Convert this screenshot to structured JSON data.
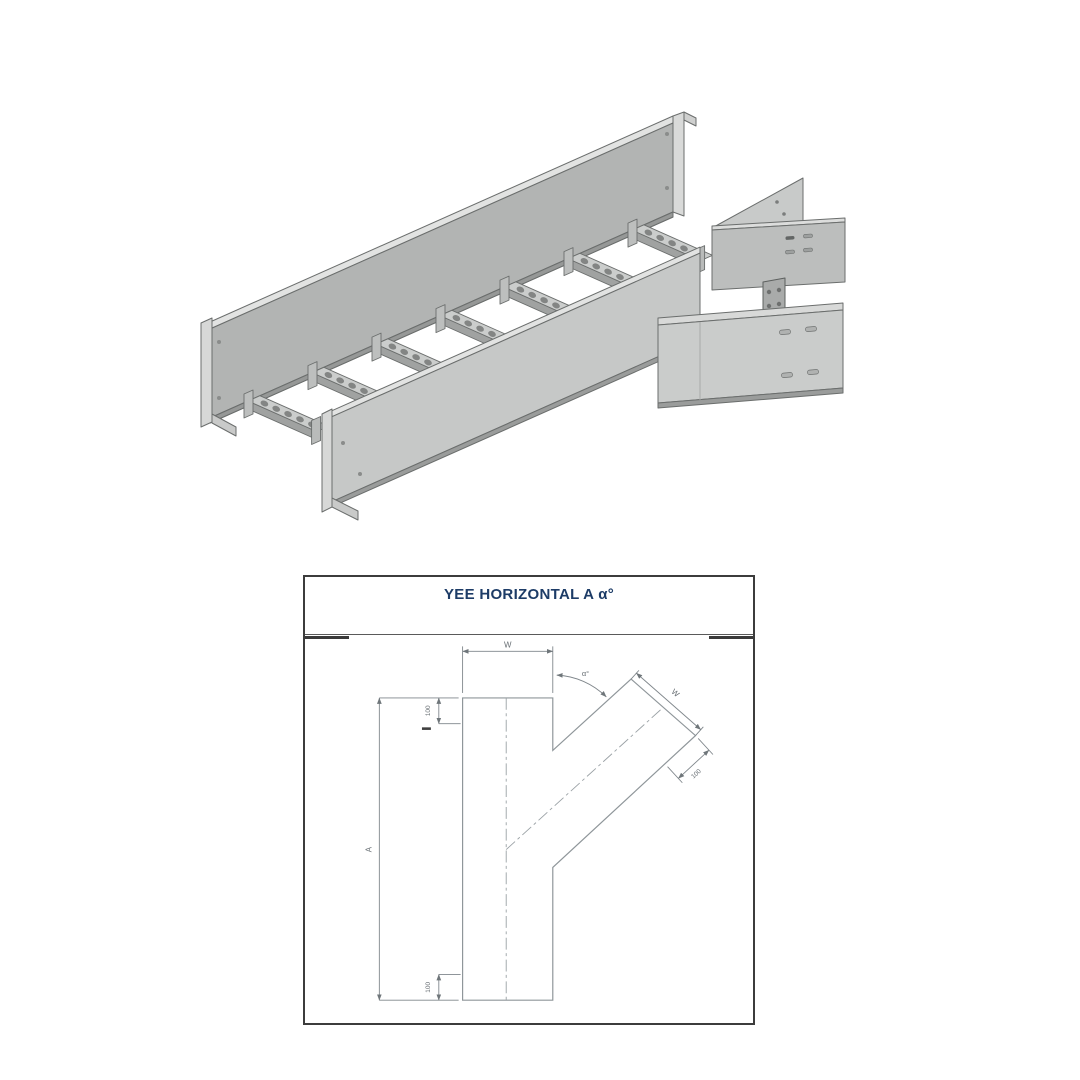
{
  "page": {
    "background": "#ffffff"
  },
  "illustration3d": {
    "description": "Isometric 3D rendering of a ladder-type cable tray horizontal yee (Y-branch) fitting",
    "rung_count": 7,
    "colors": {
      "rail_web": "#b2b4b3",
      "near_rail_web": "#c6c8c7",
      "flange_highlight": "#e2e3e2",
      "rung_top": "#cbcdcc",
      "rung_front": "#a0a2a1",
      "branch_panel": "#cacccb",
      "outline": "#6b6e6d",
      "hole": "#838584",
      "end_cap": "#d7d8d7"
    }
  },
  "drawing": {
    "title": "YEE HORIZONTAL A α°",
    "frame": {
      "border_color": "#3c3c3c",
      "line_color": "#8f969a",
      "text_color": "#666d72",
      "title_color": "#1d3c67"
    },
    "dimensions": {
      "width_main": "W",
      "width_branch": "W",
      "length_main": "A",
      "branch_angle": "α°",
      "tangent_top": "100",
      "tangent_branch": "100",
      "tangent_bottom": "100"
    }
  }
}
